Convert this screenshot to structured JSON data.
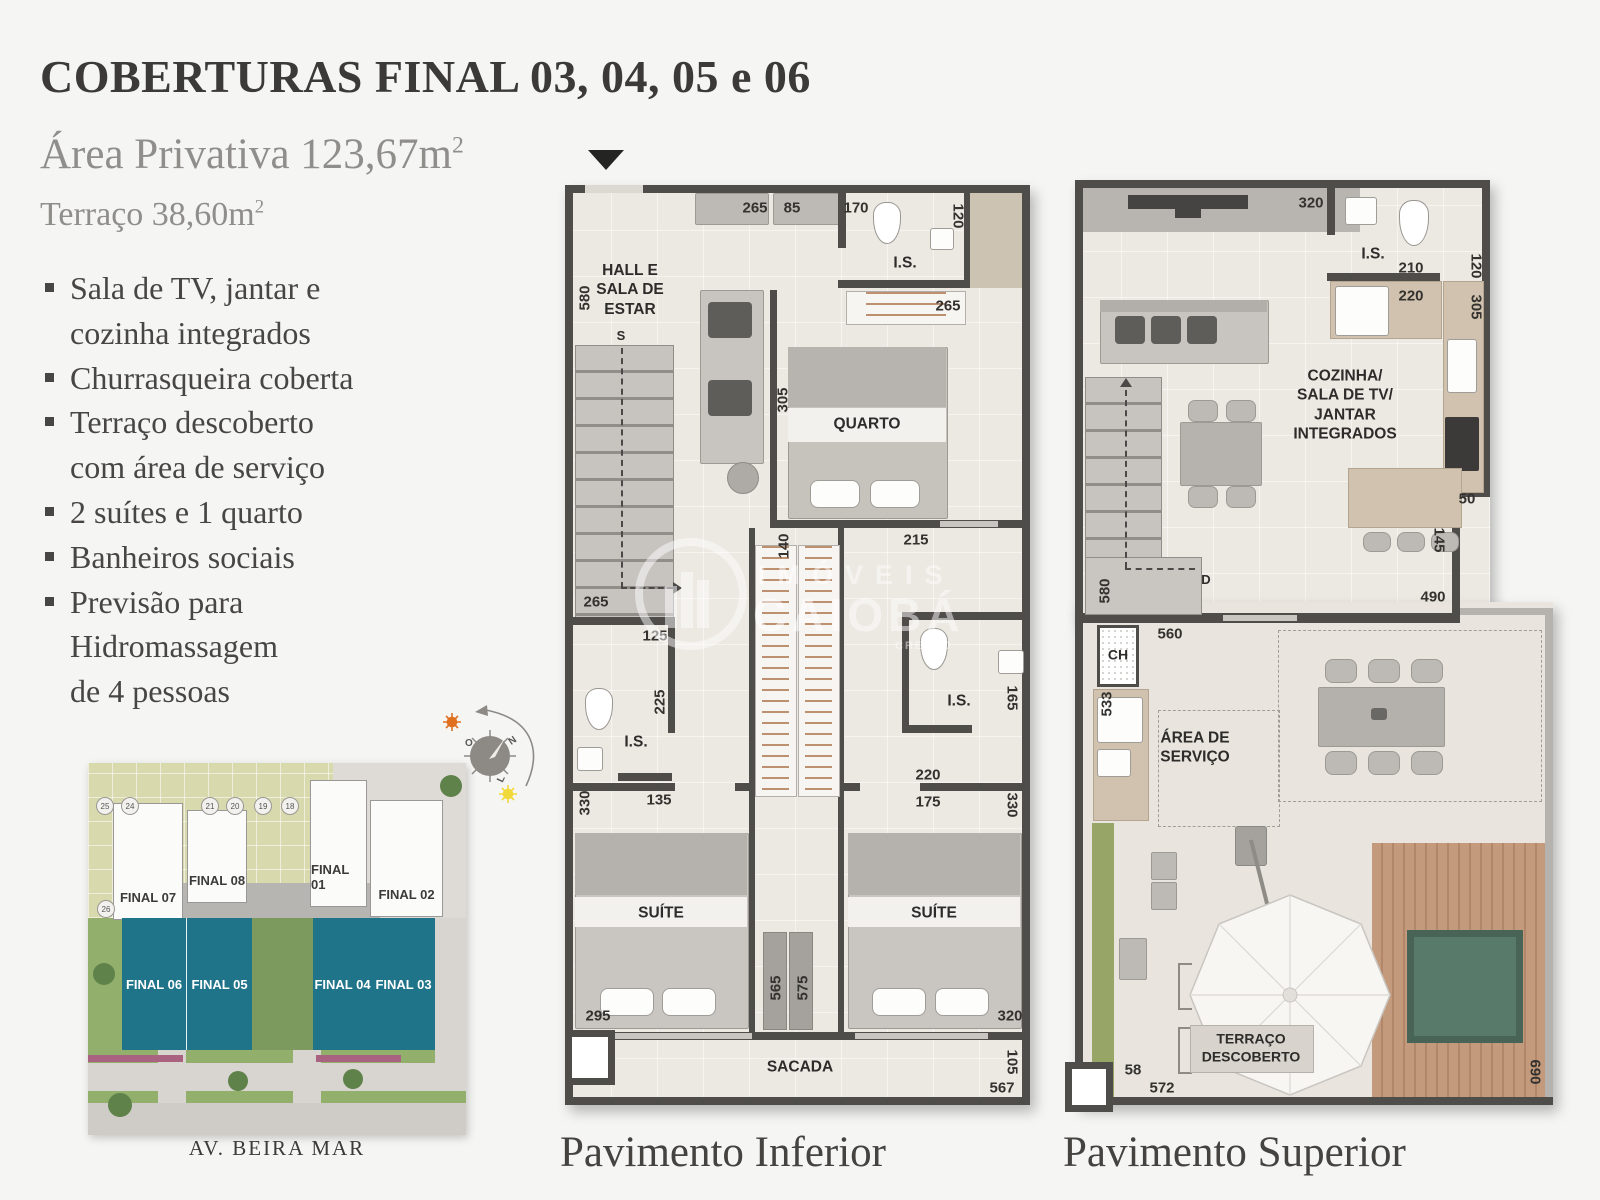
{
  "header": {
    "title": "COBERTURAS FINAL 03, 04, 05 e 06",
    "area_privativa": "Área Privativa 123,67m",
    "area_privativa_sup": "2",
    "terraco": "Terraço 38,60m",
    "terraco_sup": "2"
  },
  "features": [
    "Sala de TV, jantar e\ncozinha integrados",
    "Churrasqueira coberta",
    "Terraço descoberto\ncom área de serviço",
    "2 suítes e 1 quarto",
    "Banheiros sociais",
    "Previsão para\nHidromassagem\nde 4 pessoas"
  ],
  "compass": {
    "west": "O",
    "north": "N",
    "east": "L"
  },
  "site_plan": {
    "top_units": [
      "FINAL 07",
      "FINAL 08",
      "FINAL 01",
      "FINAL 02"
    ],
    "highlight_units": [
      "FINAL 06",
      "FINAL 05",
      "FINAL 04",
      "FINAL 03"
    ],
    "spot_numbers": [
      "25",
      "24",
      "21",
      "20",
      "19",
      "18",
      "26"
    ],
    "street": "AV. BEIRA MAR",
    "highlight_color": "#20748a"
  },
  "watermark": {
    "brand_top": "IMÓVEIS",
    "brand_bottom": "CAIOBÁ",
    "creci": "CRECI J"
  },
  "plans": {
    "inferior": {
      "caption": "Pavimento Inferior",
      "labels": {
        "hall": "HALL E\nSALA DE\nESTAR",
        "stairs": "S",
        "is_top": "I.S.",
        "quarto": "QUARTO",
        "is_left": "I.S.",
        "is_right": "I.S.",
        "suite_left": "SUÍTE",
        "suite_right": "SUÍTE",
        "sacada": "SACADA"
      },
      "dims": {
        "top_closet": "265",
        "top_door": "85",
        "top_is": "170",
        "right_is": "120",
        "left_hall": "580",
        "quarto_closet": "265",
        "quarto_h": "305",
        "corridor_w": "140",
        "corridor_l": "215",
        "stairs_w": "265",
        "bath_l_door": "125",
        "bath_l_h": "225",
        "bath_l_w": "135",
        "suite_l_side": "330",
        "bath_r_h": "165",
        "bath_r_w": "220",
        "bath_r_door": "175",
        "suite_r_side": "330",
        "closet_l": "565",
        "closet_r": "575",
        "suite_l_w": "295",
        "suite_r_w": "320",
        "sacada_d": "105",
        "sacada_w": "567"
      }
    },
    "superior": {
      "caption": "Pavimento Superior",
      "labels": {
        "is": "I.S.",
        "living": "COZINHA/\nSALA DE TV/\nJANTAR\nINTEGRADOS",
        "ch": "CH",
        "servico": "ÁREA DE\nSERVIÇO",
        "stairs": "D",
        "terraco": "TERRAÇO\nDESCOBERTO"
      },
      "dims": {
        "tv_wall": "320",
        "right_is": "120",
        "is_w": "210",
        "counter_w": "220",
        "right_kitchen": "305",
        "counter_step": "50",
        "counter_h": "145",
        "left_stairs": "580",
        "living_w": "490",
        "wall_w": "560",
        "left_servico": "533",
        "terrace_step": "58",
        "terrace_w": "572",
        "terrace_h": "690"
      }
    }
  }
}
